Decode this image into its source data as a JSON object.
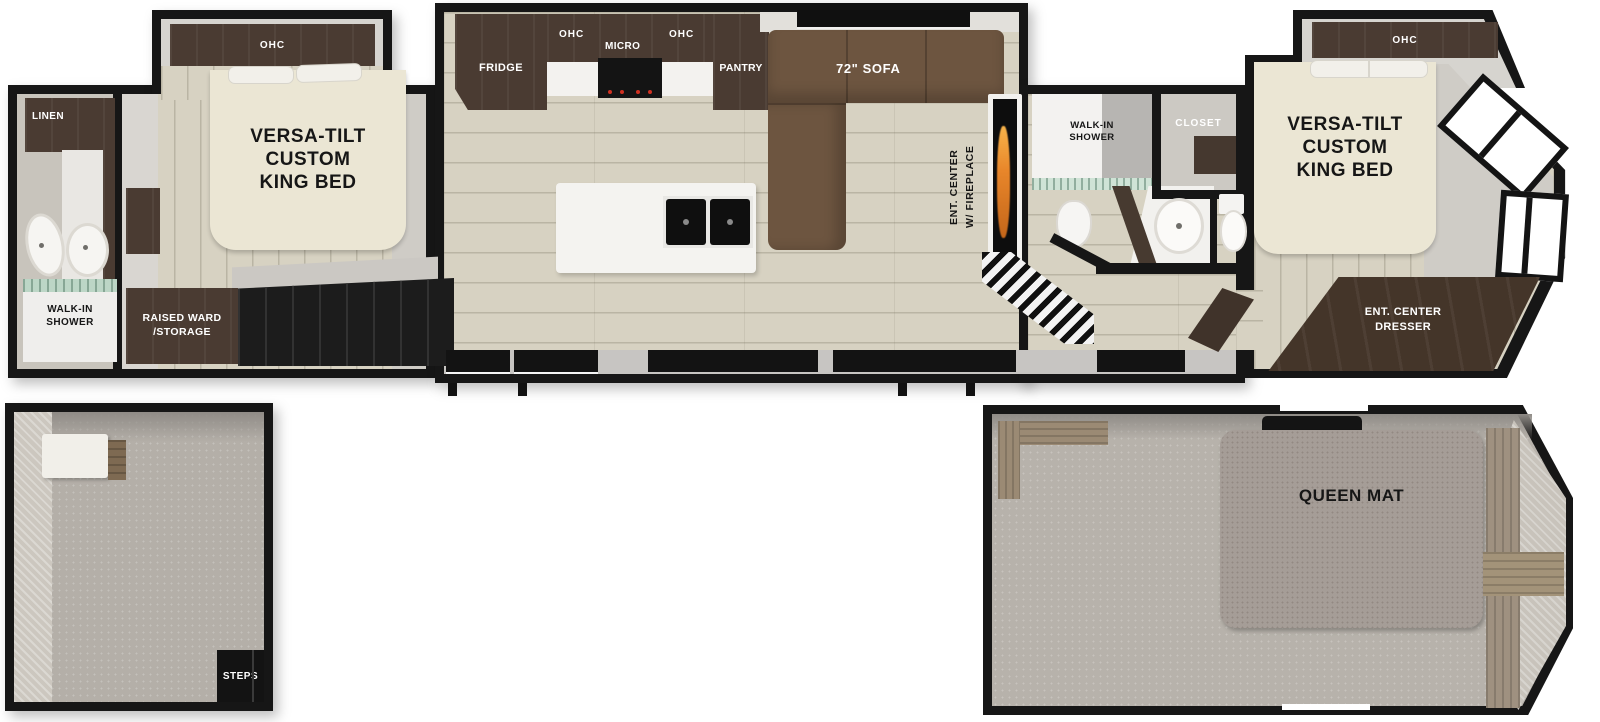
{
  "floorplan": {
    "rear_bath": {
      "linen": "LINEN",
      "shower_line1": "WALK-IN",
      "shower_line2": "SHOWER"
    },
    "rear_bedroom": {
      "ohc": "OHC",
      "bed_line1": "VERSA-TILT",
      "bed_line2": "CUSTOM",
      "bed_line3": "KING BED",
      "ward_line1": "RAISED WARD",
      "ward_line2": "/STORAGE"
    },
    "kitchen": {
      "fridge": "FRIDGE",
      "ohc_left": "OHC",
      "micro": "MICRO",
      "ohc_right": "OHC",
      "pantry": "PANTRY"
    },
    "living": {
      "sofa": "72\" SOFA",
      "ent_center_line1": "ENT. CENTER",
      "ent_center_line2": "W/ FIREPLACE"
    },
    "mid_bath": {
      "shower_line1": "WALK-IN",
      "shower_line2": "SHOWER",
      "closet": "CLOSET"
    },
    "front_bedroom": {
      "ohc": "OHC",
      "bed_line1": "VERSA-TILT",
      "bed_line2": "CUSTOM",
      "bed_line3": "KING BED",
      "dresser_line1": "ENT. CENTER",
      "dresser_line2": "DRESSER"
    },
    "rear_loft": {
      "steps": "STEPS"
    },
    "front_loft": {
      "queen_mat": "QUEEN MAT"
    }
  },
  "colors": {
    "wall": "#161616",
    "wood_floor": "#d7d2c2",
    "cabinet_dark": "#4a3b32",
    "sofa_brown": "#6d5540",
    "bed_cream": "#ebe6d4",
    "carpet_gray": "#b4afa8",
    "mat_gray": "#a59d97",
    "flame_orange": "#e8862a",
    "glass_green": "#cfe3d6"
  }
}
